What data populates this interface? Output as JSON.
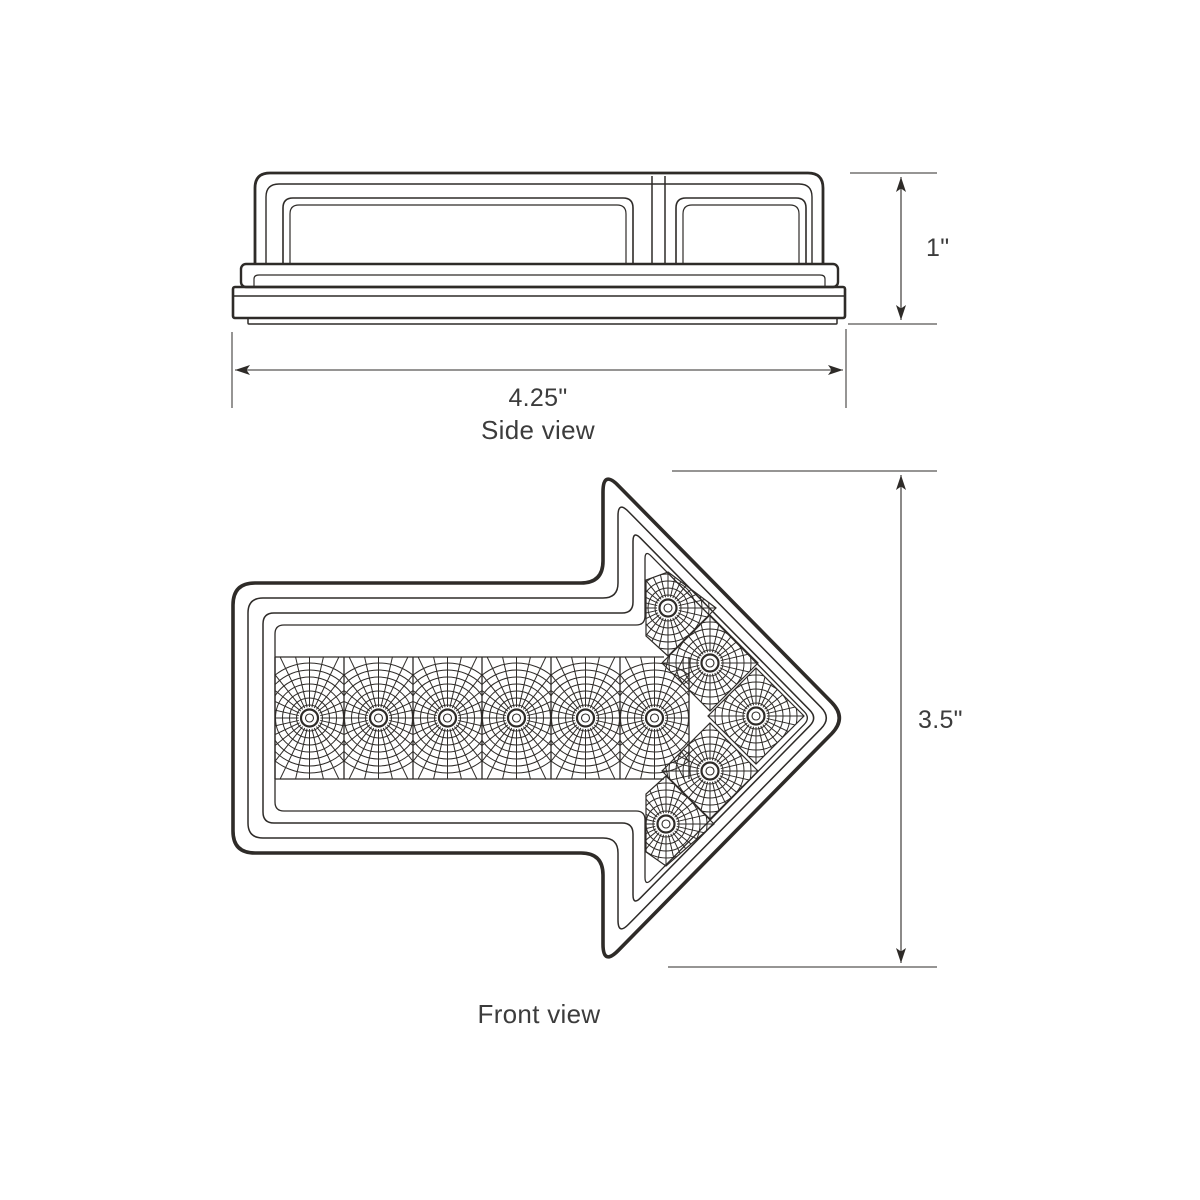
{
  "page": {
    "background": "#ffffff",
    "ink": "#2e2b28"
  },
  "side_view": {
    "caption": "Side view",
    "width_dim": {
      "label": "4.25\""
    },
    "height_dim": {
      "label": "1\""
    }
  },
  "front_view": {
    "caption": "Front view",
    "height_dim": {
      "label": "3.5\""
    },
    "arrow_direction": "right",
    "led_count": 11,
    "shaft_led_count": 6,
    "arrowhead_led_count": 5
  },
  "drawing": {
    "ink": "#2e2b28",
    "side": {
      "dome_outer": "M 255,264 L 255,188 Q 255,173 270,173 L 808,173 Q 823,173 823,188 L 823,264",
      "dome_inner": "M 266,264 L 266,197 Q 266,184 279,184 L 799,184 Q 812,184 812,197 L 812,264",
      "win_left_outer": "M 283,264 L 283,208 Q 283,198 293,198 L 623,198 Q 633,198 633,208 L 633,264 Z",
      "win_left_inner": "M 290,264 L 290,214 Q 290,205 299,205 L 617,205 Q 626,205 626,214 L 626,264 Z",
      "win_right_outer": "M 676,264 L 676,208 Q 676,198 686,198 L 796,198 Q 806,198 806,208 L 806,264 Z",
      "win_right_inner": "M 683,264 L 683,214 Q 683,205 692,205 L 790,205 Q 799,205 799,214 L 799,264 Z",
      "divider_x": [
        652,
        665
      ],
      "divider_y": [
        176,
        264
      ],
      "flange": {
        "x": 241,
        "y": 264,
        "w": 597,
        "h": 23,
        "r": 5
      },
      "flange_inner": "M 254,286 L 254,279 Q 254,275 259,275 L 820,275 Q 825,275 825,279 L 825,286",
      "bar": {
        "x": 233,
        "y": 287,
        "w": 612,
        "h": 31,
        "r": 2
      },
      "bar_line_y": 296,
      "lip": {
        "x": 248,
        "y": 318,
        "w": 589,
        "h": 6,
        "r": 1
      }
    },
    "front": {
      "base_points": [
        [
          233,
          583
        ],
        [
          603,
          583
        ],
        [
          603,
          470
        ],
        [
          847,
          718
        ],
        [
          603,
          966
        ],
        [
          603,
          853
        ],
        [
          233,
          853
        ]
      ],
      "outlines": [
        {
          "insets": [
            0,
            0,
            0,
            0,
            0,
            0,
            0
          ],
          "radius": 22,
          "width": 3.6
        },
        {
          "insets": [
            15,
            15,
            11,
            11,
            15,
            15,
            15
          ],
          "radius": 15,
          "width": 1.5
        },
        {
          "insets": [
            30,
            30,
            21,
            21,
            30,
            30,
            30
          ],
          "radius": 11,
          "width": 1.5
        },
        {
          "insets": [
            42,
            42,
            26,
            26,
            42,
            42,
            42
          ],
          "radius": 9,
          "width": 1.3
        }
      ],
      "band": {
        "x0": 275,
        "x1": 689,
        "y0": 657,
        "y1": 779,
        "cells": 6,
        "top_line_end": 664
      },
      "row_led_y": 718,
      "head_leds": [
        [
          668,
          608
        ],
        [
          710,
          663
        ],
        [
          756,
          716
        ],
        [
          710,
          771
        ],
        [
          666,
          824
        ]
      ],
      "head_cells": [
        [
          [
            668,
            572
          ],
          [
            716,
            608
          ],
          [
            668,
            656
          ],
          [
            646,
            636
          ],
          [
            646,
            580
          ]
        ],
        [
          [
            710,
            615
          ],
          [
            758,
            663
          ],
          [
            710,
            711
          ],
          [
            662,
            663
          ]
        ],
        [
          [
            756,
            668
          ],
          [
            804,
            716
          ],
          [
            756,
            764
          ],
          [
            708,
            716
          ]
        ],
        [
          [
            710,
            723
          ],
          [
            758,
            771
          ],
          [
            710,
            819
          ],
          [
            662,
            771
          ]
        ],
        [
          [
            666,
            776
          ],
          [
            714,
            824
          ],
          [
            666,
            866
          ],
          [
            646,
            852
          ],
          [
            646,
            794
          ]
        ]
      ],
      "star_row": {
        "rays": 28,
        "r0": 11,
        "r1": 84,
        "rings": [
          13,
          20,
          27,
          34,
          41,
          48,
          55
        ]
      },
      "star_head": {
        "rays": 28,
        "r0": 11,
        "r1": 64,
        "rings": [
          13,
          20,
          27,
          34,
          41
        ]
      }
    },
    "dims": [
      {
        "ext": [
          [
            850,
            173,
            937,
            173
          ],
          [
            848,
            324,
            937,
            324
          ]
        ],
        "line": [
          901,
          177,
          901,
          320
        ],
        "a1": "up",
        "a2": "down"
      },
      {
        "ext": [
          [
            232,
            332,
            232,
            408
          ],
          [
            846,
            329,
            846,
            408
          ]
        ],
        "line": [
          235,
          370,
          843,
          370
        ],
        "a1": "left",
        "a2": "right"
      },
      {
        "ext": [
          [
            672,
            471,
            937,
            471
          ],
          [
            668,
            967,
            937,
            967
          ]
        ],
        "line": [
          901,
          475,
          901,
          963
        ],
        "a1": "up",
        "a2": "down"
      }
    ]
  }
}
